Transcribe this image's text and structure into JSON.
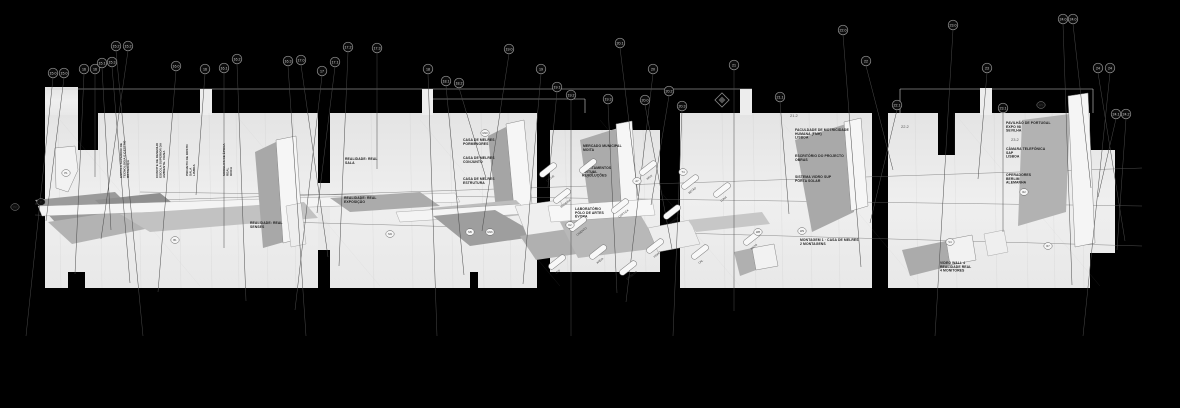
{
  "drawing": {
    "background": "#000000",
    "sheet_color": "#ececec",
    "line_color": "#555555",
    "icons": {
      "stamp": "diamond-logo"
    },
    "callouts": [
      {
        "label": "15.0",
        "x": 53,
        "y": 73
      },
      {
        "label": "15.0",
        "x": 64,
        "y": 73
      },
      {
        "label": "16",
        "x": 84,
        "y": 69
      },
      {
        "label": "16",
        "x": 95,
        "y": 69
      },
      {
        "label": "15.1",
        "x": 102,
        "y": 63
      },
      {
        "label": "15.3",
        "x": 112,
        "y": 62
      },
      {
        "label": "15.2",
        "x": 116,
        "y": 46
      },
      {
        "label": "15.2",
        "x": 128,
        "y": 46
      },
      {
        "label": "16.0",
        "x": 176,
        "y": 66
      },
      {
        "label": "16",
        "x": 205,
        "y": 69
      },
      {
        "label": "16.1",
        "x": 224,
        "y": 68
      },
      {
        "label": "16.2",
        "x": 237,
        "y": 59
      },
      {
        "label": "16.3",
        "x": 288,
        "y": 61
      },
      {
        "label": "17.0",
        "x": 301,
        "y": 60
      },
      {
        "label": "17",
        "x": 322,
        "y": 71
      },
      {
        "label": "17.1",
        "x": 335,
        "y": 62
      },
      {
        "label": "17.2",
        "x": 348,
        "y": 47
      },
      {
        "label": "17.3",
        "x": 377,
        "y": 48
      },
      {
        "label": "18",
        "x": 428,
        "y": 69
      },
      {
        "label": "18.1",
        "x": 446,
        "y": 81
      },
      {
        "label": "18.2",
        "x": 459,
        "y": 83
      },
      {
        "label": "19.0",
        "x": 509,
        "y": 49
      },
      {
        "label": "19",
        "x": 541,
        "y": 69
      },
      {
        "label": "19.1",
        "x": 557,
        "y": 87
      },
      {
        "label": "19.2",
        "x": 571,
        "y": 95
      },
      {
        "label": "19.3",
        "x": 608,
        "y": 99
      },
      {
        "label": "20.1",
        "x": 620,
        "y": 43
      },
      {
        "label": "20.0",
        "x": 645,
        "y": 100
      },
      {
        "label": "20",
        "x": 653,
        "y": 69
      },
      {
        "label": "20.2",
        "x": 669,
        "y": 91
      },
      {
        "label": "20.3",
        "x": 682,
        "y": 106
      },
      {
        "label": "21",
        "x": 734,
        "y": 65
      },
      {
        "label": "21.1",
        "x": 780,
        "y": 97
      },
      {
        "label": "22.0",
        "x": 843,
        "y": 30
      },
      {
        "label": "22",
        "x": 866,
        "y": 61
      },
      {
        "label": "22.1",
        "x": 897,
        "y": 105
      },
      {
        "label": "23.0",
        "x": 953,
        "y": 25
      },
      {
        "label": "23",
        "x": 987,
        "y": 68
      },
      {
        "label": "23.1",
        "x": 1003,
        "y": 108
      },
      {
        "label": "24.0",
        "x": 1063,
        "y": 19
      },
      {
        "label": "24.0",
        "x": 1073,
        "y": 19
      },
      {
        "label": "24",
        "x": 1098,
        "y": 68
      },
      {
        "label": "24",
        "x": 1110,
        "y": 68
      },
      {
        "label": "24.1",
        "x": 1116,
        "y": 114
      },
      {
        "label": "24.2",
        "x": 1126,
        "y": 114
      }
    ],
    "field_marks": [
      {
        "label": "P2",
        "x": 15,
        "y": 207
      },
      {
        "label": "P",
        "x": 41,
        "y": 202
      },
      {
        "label": "P1",
        "x": 66,
        "y": 173
      },
      {
        "label": "B1",
        "x": 175,
        "y": 240
      },
      {
        "label": "M3",
        "x": 390,
        "y": 234
      },
      {
        "label": "M5",
        "x": 470,
        "y": 232
      },
      {
        "label": "M16",
        "x": 490,
        "y": 232
      },
      {
        "label": "M10",
        "x": 485,
        "y": 133
      },
      {
        "label": "K2",
        "x": 570,
        "y": 225
      },
      {
        "label": "A7",
        "x": 637,
        "y": 181
      },
      {
        "label": "T4",
        "x": 683,
        "y": 172
      },
      {
        "label": "W8",
        "x": 758,
        "y": 232
      },
      {
        "label": "W9",
        "x": 802,
        "y": 231
      },
      {
        "label": "V4",
        "x": 950,
        "y": 242
      },
      {
        "label": "R2",
        "x": 1024,
        "y": 192
      },
      {
        "label": "R7",
        "x": 1048,
        "y": 246
      },
      {
        "label": "WV",
        "x": 1041,
        "y": 105
      }
    ],
    "notes": [
      {
        "x": 345,
        "y": 160,
        "lines": [
          "REALIDADE: REAL",
          "SALA"
        ]
      },
      {
        "x": 344,
        "y": 199,
        "lines": [
          "REALIDADE: REAL",
          "EXPOSIÇÃO"
        ]
      },
      {
        "x": 250,
        "y": 224,
        "lines": [
          "REALIDADE: REAL",
          "SENSES"
        ]
      },
      {
        "x": 463,
        "y": 141,
        "lines": [
          "CASA DE MELRES",
          "PORMENORES"
        ]
      },
      {
        "x": 463,
        "y": 159,
        "lines": [
          "CASA DE MELRES",
          "CONJUNTO"
        ]
      },
      {
        "x": 463,
        "y": 180,
        "lines": [
          "CASA DE MELRES",
          "ESTRUTURA"
        ]
      },
      {
        "x": 583,
        "y": 147,
        "lines": [
          "MERCADO MUNICIPAL",
          "MOITA"
        ]
      },
      {
        "x": 582,
        "y": 169,
        "lines": [
          "APARTAMENTOS",
          "VIRTUAL",
          "REVOLUÇÕES"
        ]
      },
      {
        "x": 575,
        "y": 210,
        "lines": [
          "LABORATÓRIO",
          "PÓLO DE ARTES",
          "ÉVORA"
        ]
      },
      {
        "x": 795,
        "y": 131,
        "lines": [
          "FACULDADE DE MOTRICIDADE",
          "HUMANA (FMH)",
          "LISBOA"
        ]
      },
      {
        "x": 795,
        "y": 157,
        "lines": [
          "ESCRITÓRIO DO PROJECTO",
          "OBRAS"
        ]
      },
      {
        "x": 795,
        "y": 178,
        "lines": [
          "SISTEMA VIDRO SUP",
          "PORTA SOLAR"
        ]
      },
      {
        "x": 800,
        "y": 241,
        "lines": [
          "MONTAGEM 1 · CASA DE MELRES",
          "2 MONTAGENS"
        ]
      },
      {
        "x": 1006,
        "y": 124,
        "lines": [
          "PAVILHÃO DE PORTUGAL",
          "EXPO 98",
          "SEVILHA"
        ]
      },
      {
        "x": 1006,
        "y": 150,
        "lines": [
          "CÂMARA TELEFÓNICA",
          "SAP",
          "LISBOA"
        ]
      },
      {
        "x": 1006,
        "y": 176,
        "lines": [
          "OPERADORES",
          "BERLIM",
          "ALEMANHA"
        ]
      },
      {
        "x": 940,
        "y": 264,
        "lines": [
          "VIDEO WALL 4",
          "REALIDADE REAL",
          "4 MONITORES"
        ]
      }
    ],
    "vertical_notes": [
      {
        "x": 122,
        "y": 178,
        "lines": [
          "ESCOLA SUPERIOR DE",
          "TECNOLOGIA E GESTÃO",
          "BRAGANÇA"
        ]
      },
      {
        "x": 158,
        "y": 178,
        "lines": [
          "CONVITE DE DESENHO",
          "ESCOLA SUPERIOR DA",
          "AMBIENTE. VIANA"
        ]
      },
      {
        "x": 188,
        "y": 176,
        "lines": [
          "PROJETO DE ROSTO",
          "SALA",
          "LISBOA"
        ]
      },
      {
        "x": 225,
        "y": 176,
        "lines": [
          "MODELOS DE ÉPOCA",
          "REAL",
          "DOCA"
        ]
      }
    ],
    "material_angle": -38,
    "materials": [
      {
        "x": 548,
        "y": 170,
        "label": "CHUVA"
      },
      {
        "x": 562,
        "y": 196,
        "label": "MADEIRA"
      },
      {
        "x": 578,
        "y": 224,
        "label": "CIMENTO"
      },
      {
        "x": 598,
        "y": 252,
        "label": "AREIA"
      },
      {
        "x": 628,
        "y": 268,
        "label": "ESPELHO"
      },
      {
        "x": 655,
        "y": 246,
        "label": "VIDRO"
      },
      {
        "x": 672,
        "y": 212,
        "label": "PEDRA"
      },
      {
        "x": 690,
        "y": 182,
        "label": "BETÃO"
      },
      {
        "x": 588,
        "y": 166,
        "label": "GESSO"
      },
      {
        "x": 620,
        "y": 206,
        "label": "CORTIÇA"
      },
      {
        "x": 648,
        "y": 168,
        "label": "INOX"
      },
      {
        "x": 700,
        "y": 252,
        "label": "CAL"
      },
      {
        "x": 722,
        "y": 190,
        "label": "LONA"
      },
      {
        "x": 752,
        "y": 238,
        "label": "XISTO"
      },
      {
        "x": 557,
        "y": 262,
        "label": "LED"
      }
    ],
    "printed_numbers": [
      {
        "text": "21.2",
        "x": 790,
        "y": 117
      },
      {
        "text": "22.2",
        "x": 901,
        "y": 128
      },
      {
        "text": "23.2",
        "x": 1011,
        "y": 141
      }
    ]
  }
}
